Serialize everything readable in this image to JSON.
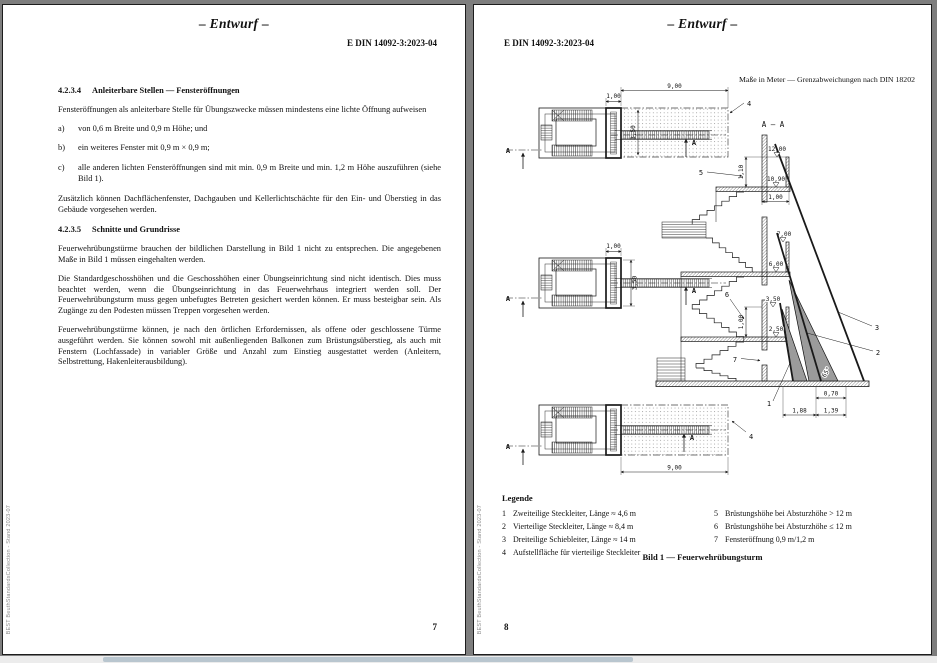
{
  "doc": {
    "draft_label": "– Entwurf –",
    "doc_number": "E DIN 14092-3:2023-04",
    "watermark": "BEST BeuthStandardsCollection - Stand 2023-07"
  },
  "left_page": {
    "page_number": "7",
    "section1": {
      "number": "4.2.3.4",
      "title": "Anleiterbare Stellen — Fensteröffnungen",
      "intro": "Fensteröffnungen als anleiterbare Stelle für Übungszwecke müssen mindestens eine lichte Öffnung aufweisen",
      "items": [
        {
          "marker": "a)",
          "text": "von 0,6 m Breite und 0,9 m Höhe; und"
        },
        {
          "marker": "b)",
          "text": "ein weiteres Fenster mit 0,9 m × 0,9 m;"
        },
        {
          "marker": "c)",
          "text": "alle anderen lichten Fensteröffnungen sind mit min. 0,9 m Breite und min. 1,2 m Höhe auszuführen (siehe Bild 1)."
        }
      ],
      "outro": "Zusätzlich können Dachflächenfenster, Dachgauben und Kellerlichtschächte für den Ein- und Überstieg in das Gebäude vorgesehen werden."
    },
    "section2": {
      "number": "4.2.3.5",
      "title": "Schnitte und Grundrisse",
      "para1": "Feuerwehrübungstürme brauchen der bildlichen Darstellung in Bild 1 nicht zu entsprechen. Die angegebenen Maße in Bild 1 müssen eingehalten werden.",
      "para2": "Die Standardgeschosshöhen und die Geschosshöhen einer Übungseinrichtung sind nicht identisch. Dies muss beachtet werden, wenn die Übungseinrichtung in das Feuerwehrhaus integriert werden soll. Der Feuerwehrübungsturm muss gegen unbefugtes Betreten gesichert werden können. Er muss besteigbar sein. Als Zugänge zu den Podesten müssen Treppen vorgesehen werden.",
      "para3": "Feuerwehrübungstürme können, je nach den örtlichen Erfordernissen, als offene oder geschlossene Türme ausgeführt werden. Sie können sowohl mit außenliegenden Balkonen zum Brüstungsüberstieg, als auch mit Fenstern (Lochfassade) in variabler Größe und Anzahl zum Einstieg ausgestattet werden (Anleitern, Selbstrettung, Hakenleiterausbildung)."
    }
  },
  "right_page": {
    "page_number": "8",
    "units_note": "Maße in Meter — Grenzabweichungen nach DIN 18202",
    "figure": {
      "section_title": "A – A",
      "dims": {
        "one_m": "1,00",
        "nine_m": "9,00",
        "area_depth": "3,50",
        "parapet_high": "1,10",
        "lvl_12": "12,00",
        "lvl_10_9": "10,90",
        "lvl_7": "7,00",
        "lvl_6": "6,00",
        "lvl_3_5": "3,50",
        "lvl_2_5": "2,50",
        "w_070": "0,70",
        "w_188": "1,88",
        "w_139": "1,39",
        "angle": "65°",
        "section_mark": "A"
      },
      "callouts": {
        "c1": "1",
        "c2": "2",
        "c3": "3",
        "c4": "4",
        "c5": "5",
        "c6": "6",
        "c7": "7"
      }
    },
    "legend": {
      "title": "Legende",
      "col1": [
        {
          "num": "1",
          "text": "Zweiteilige Steckleiter, Länge ≈ 4,6 m"
        },
        {
          "num": "2",
          "text": "Vierteilige Steckleiter, Länge ≈ 8,4 m"
        },
        {
          "num": "3",
          "text": "Dreiteilige Schiebleiter, Länge ≈ 14 m"
        },
        {
          "num": "4",
          "text": "Aufstellfläche für vierteilige Steckleiter"
        }
      ],
      "col2": [
        {
          "num": "5",
          "text": "Brüstungshöhe bei Absturzhöhe > 12 m"
        },
        {
          "num": "6",
          "text": "Brüstungshöhe bei Absturzhöhe ≤ 12 m"
        },
        {
          "num": "7",
          "text": "Fensteröffnung 0,9 m/1,2 m"
        }
      ]
    },
    "caption": "Bild 1 — Feuerwehrübungsturm"
  }
}
